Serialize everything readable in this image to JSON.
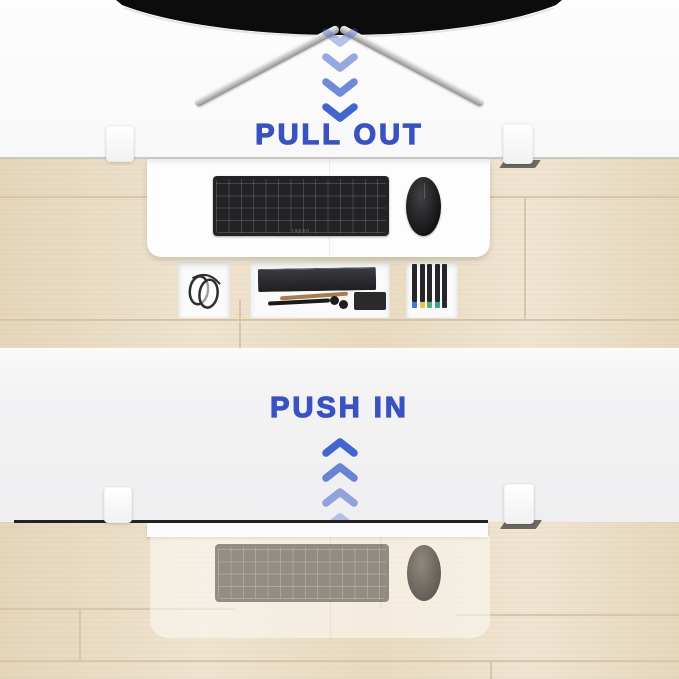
{
  "panels": {
    "top": {
      "label": "PULL OUT",
      "arrow_direction": "down",
      "arrow_count": 4
    },
    "bottom": {
      "label": "PUSH IN",
      "arrow_direction": "up",
      "arrow_count": 4
    }
  },
  "objects": {
    "keyboard_brand": "rapoo"
  },
  "colors": {
    "accent_blue": "#3853c0",
    "chevron_blue": "#4365ce",
    "desk_white": "#f7f7f8",
    "desk_gray": "#f2f2f3",
    "wood_base": "#ebdec6",
    "wood_seam": "#d7c6a8",
    "monitor_black": "#0c0c0c",
    "keyboard_black": "#232325",
    "marker_tip_1": "#4a72d8",
    "marker_tip_2": "#e2c74f",
    "marker_tip_3": "#53b06e",
    "marker_tip_4": "#38a39b",
    "marker_tip_5": "#2b2b2f"
  }
}
